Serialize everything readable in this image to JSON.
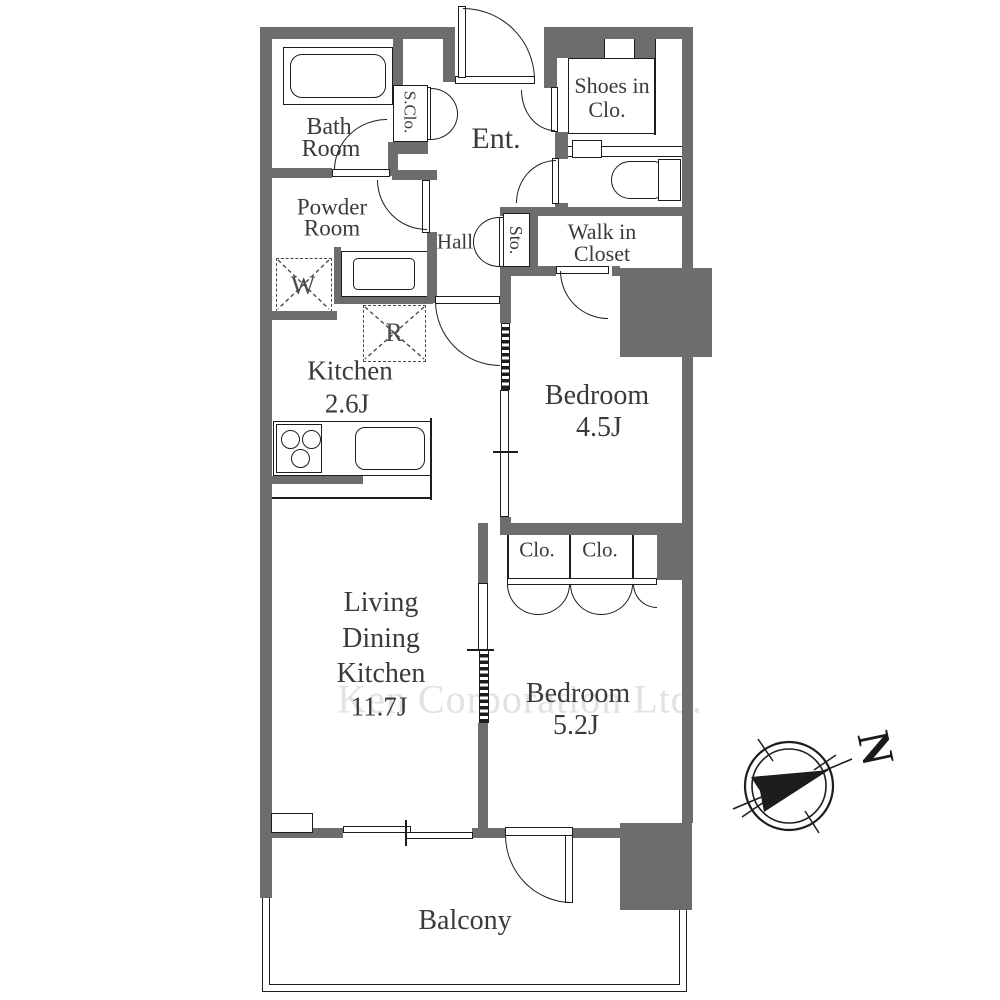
{
  "floorplan": {
    "watermark": "Ken Corporation Ltd.",
    "compass_north": "N",
    "rooms": {
      "bath": {
        "line1": "Bath",
        "line2": "Room"
      },
      "powder": {
        "line1": "Powder",
        "line2": "Room"
      },
      "s_clo": "S.Clo.",
      "entrance": "Ent.",
      "hall": "Hall",
      "storage": "Sto.",
      "shoes_closet": {
        "line1": "Shoes in",
        "line2": "Clo."
      },
      "walk_in_closet": {
        "line1": "Walk in",
        "line2": "Closet"
      },
      "kitchen": {
        "name": "Kitchen",
        "size": "2.6J"
      },
      "bedroom1": {
        "name": "Bedroom",
        "size": "4.5J"
      },
      "bedroom2": {
        "name": "Bedroom",
        "size": "5.2J"
      },
      "ldk": {
        "line1": "Living",
        "line2": "Dining",
        "line3": "Kitchen",
        "size": "11.7J"
      },
      "closet1": "Clo.",
      "closet2": "Clo.",
      "balcony": "Balcony"
    },
    "appliances": {
      "washer": "W",
      "refrigerator": "R"
    },
    "colors": {
      "wall": "#6d6d6d",
      "line": "#1d1d1d",
      "text": "#3a3a3a",
      "watermark": "#e2e2e2"
    }
  }
}
